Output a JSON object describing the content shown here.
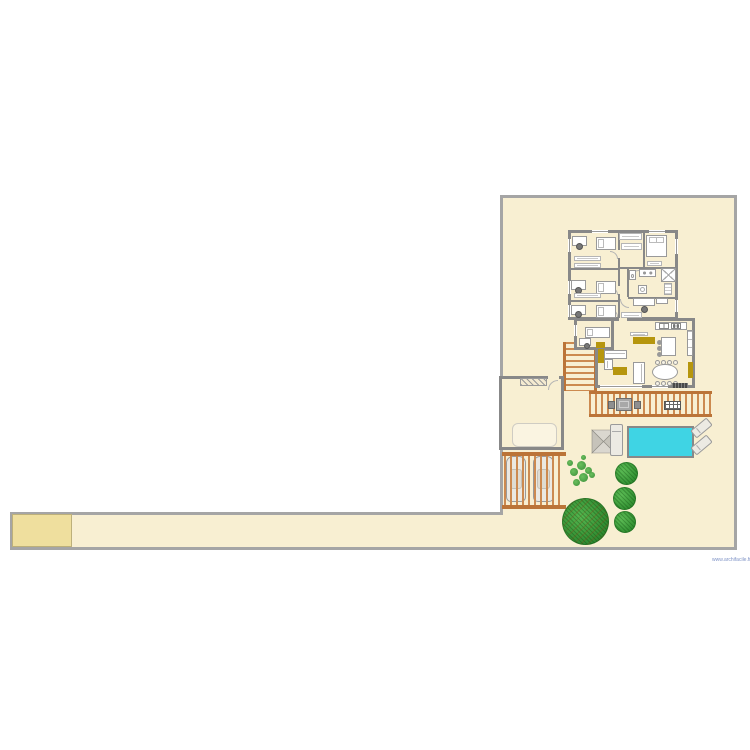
{
  "document": {
    "type": "floor-plan",
    "watermark": "www.archifacile.fr"
  },
  "colors": {
    "canvas": "#ffffff",
    "plot_fill": "#f8efd2",
    "plot_border": "#a5a5a5",
    "wall": "#888888",
    "accent": "#b6960e",
    "pool": "#3fd4e4",
    "wood": "#cc8a50",
    "wood_dark": "#bb7438",
    "driveway": "#efdf9e",
    "leaf": "#3fa53f",
    "leaf_dark": "#2e8430",
    "watermark_color": "#7f93c6"
  },
  "plan": {
    "areas": [
      "plot",
      "driveway",
      "bedroom-wing",
      "living-block",
      "guest-room-annex",
      "garage",
      "carport",
      "west-deck",
      "south-deck",
      "pool-terrace",
      "garden"
    ],
    "rooms": [
      {
        "name": "bedroom-1",
        "furniture": [
          "single-bed",
          "desk",
          "office-chair",
          "wardrobe",
          "wardrobe"
        ]
      },
      {
        "name": "bedroom-2",
        "furniture": [
          "single-bed",
          "desk",
          "office-chair",
          "wardrobe"
        ]
      },
      {
        "name": "bedroom-3",
        "furniture": [
          "single-bed",
          "desk",
          "office-chair"
        ]
      },
      {
        "name": "dressing",
        "furniture": [
          "wardrobe",
          "wardrobe"
        ]
      },
      {
        "name": "master-bedroom",
        "furniture": [
          "double-bed",
          "cabinet"
        ]
      },
      {
        "name": "bathroom",
        "furniture": [
          "toilet",
          "double-sink",
          "shower",
          "washing-machine",
          "shelf"
        ]
      },
      {
        "name": "office",
        "furniture": [
          "desk",
          "office-chair",
          "bench",
          "wardrobe"
        ]
      },
      {
        "name": "guest-bedroom",
        "furniture": [
          "single-bed",
          "desk",
          "office-chair",
          "dresser"
        ]
      },
      {
        "name": "living-room",
        "furniture": [
          "corner-sofa",
          "sofa",
          "coffee-table",
          "tv-cabinet",
          "sideboard"
        ]
      },
      {
        "name": "kitchen",
        "furniture": [
          "counter",
          "sink",
          "stove",
          "island",
          "stools-x3",
          "tall-cabinet"
        ]
      },
      {
        "name": "dining-area",
        "furniture": [
          "oval-table",
          "chairs-x8",
          "cabinet",
          "floor-mat"
        ]
      },
      {
        "name": "garage",
        "furniture": [
          "car-outline",
          "garage-door"
        ]
      }
    ],
    "outdoor_items": [
      "pergola-carport-with-2-cars",
      "outdoor-dining-set",
      "bbq-grill",
      "swimming-pool",
      "parasol",
      "sun-lounger-x3",
      "shrub-x3",
      "small-plant",
      "large-tree"
    ]
  }
}
